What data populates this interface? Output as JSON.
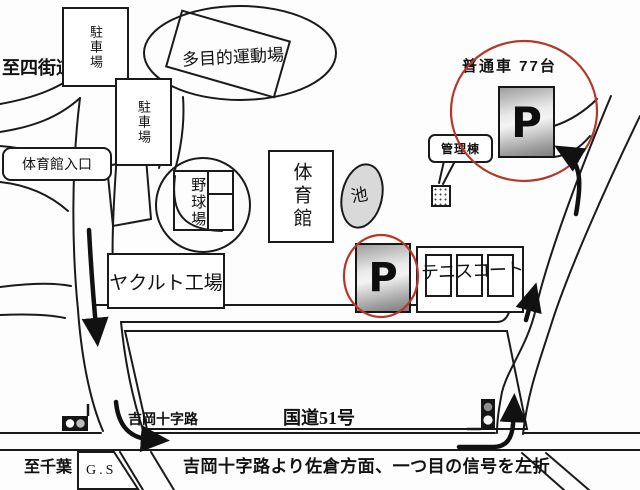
{
  "title": "facility access map",
  "colors": {
    "ink": "#1a1a1a",
    "highlight_red": "#b5372a",
    "pond_fill": "#d9d9d9",
    "parking_sign_gray": "#9e9e9e"
  },
  "labels": {
    "to_station": "至四街道駅",
    "parking_lot_1": "駐車場",
    "parking_lot_2": "駐車場",
    "multipurpose_ground": "多目的運動場",
    "gym_entrance": "体育館入口",
    "baseball_ground": "野球場",
    "gymnasium": "体育館",
    "pond": "池",
    "admin_building": "管理棟",
    "main_parking_capacity": "普通車 77台",
    "parking_symbol": "P",
    "tennis_court": "テニスコート",
    "yakult_factory": "ヤクルト工場",
    "crossroads": "吉岡十字路",
    "route_51": "国道51号",
    "to_chiba": "至千葉",
    "gas_station": "G.S",
    "instruction": "吉岡十字路より佐倉方面、一つ目の信号を左折"
  },
  "icons": {
    "traffic_light_left": "traffic-light",
    "traffic_light_right": "traffic-light",
    "route_arrows": "thick black direction arrows",
    "parking_highlight": "red circle"
  }
}
